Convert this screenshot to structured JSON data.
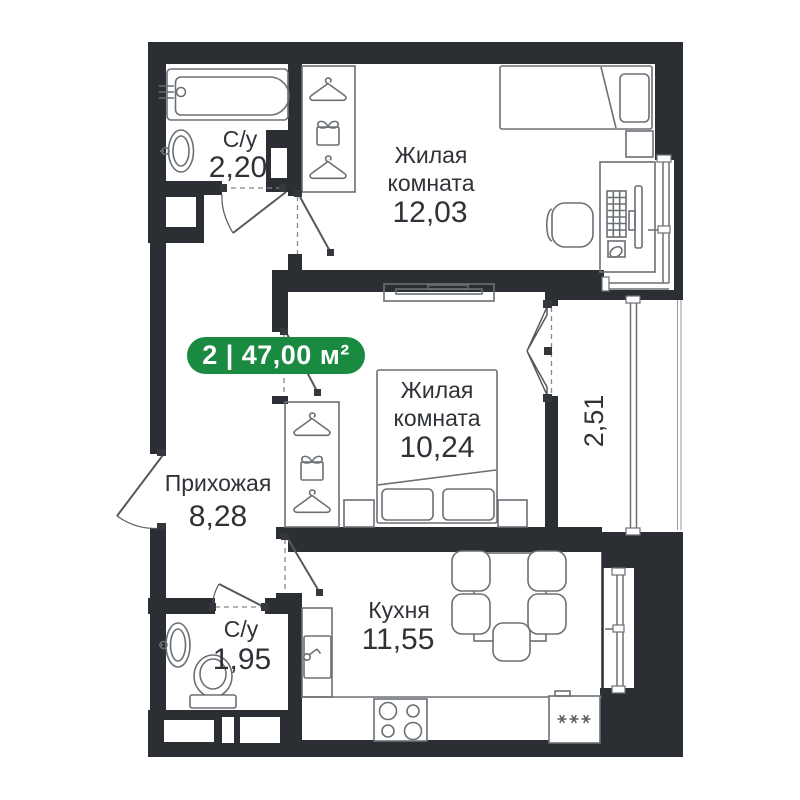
{
  "badge": {
    "label": "2 | 47,00 м²",
    "color": "#1a8a41"
  },
  "rooms": {
    "bathroom_top": {
      "name": "С/у",
      "area": "2,20"
    },
    "bedroom_top": {
      "name_line1": "Жилая",
      "name_line2": "комната",
      "area": "12,03"
    },
    "bedroom_middle": {
      "name_line1": "Жилая",
      "name_line2": "комната",
      "area": "10,24"
    },
    "hallway": {
      "name": "Прихожая",
      "area": "8,28"
    },
    "bathroom_bottom": {
      "name": "С/у",
      "area": "1,95"
    },
    "kitchen": {
      "name": "Кухня",
      "area": "11,55"
    },
    "balcony": {
      "area": "2,51"
    }
  },
  "colors": {
    "background": "#ffffff",
    "wall": "#2b2e33",
    "furniture_line": "#6b7075",
    "text": "#2f3338",
    "badge_green": "#1a8a41"
  },
  "icons": {
    "wardrobe_stack": [
      "hanger-icon",
      "storage-box-icon",
      "hanger-icon"
    ],
    "fridge": "frost-stars-icon"
  }
}
